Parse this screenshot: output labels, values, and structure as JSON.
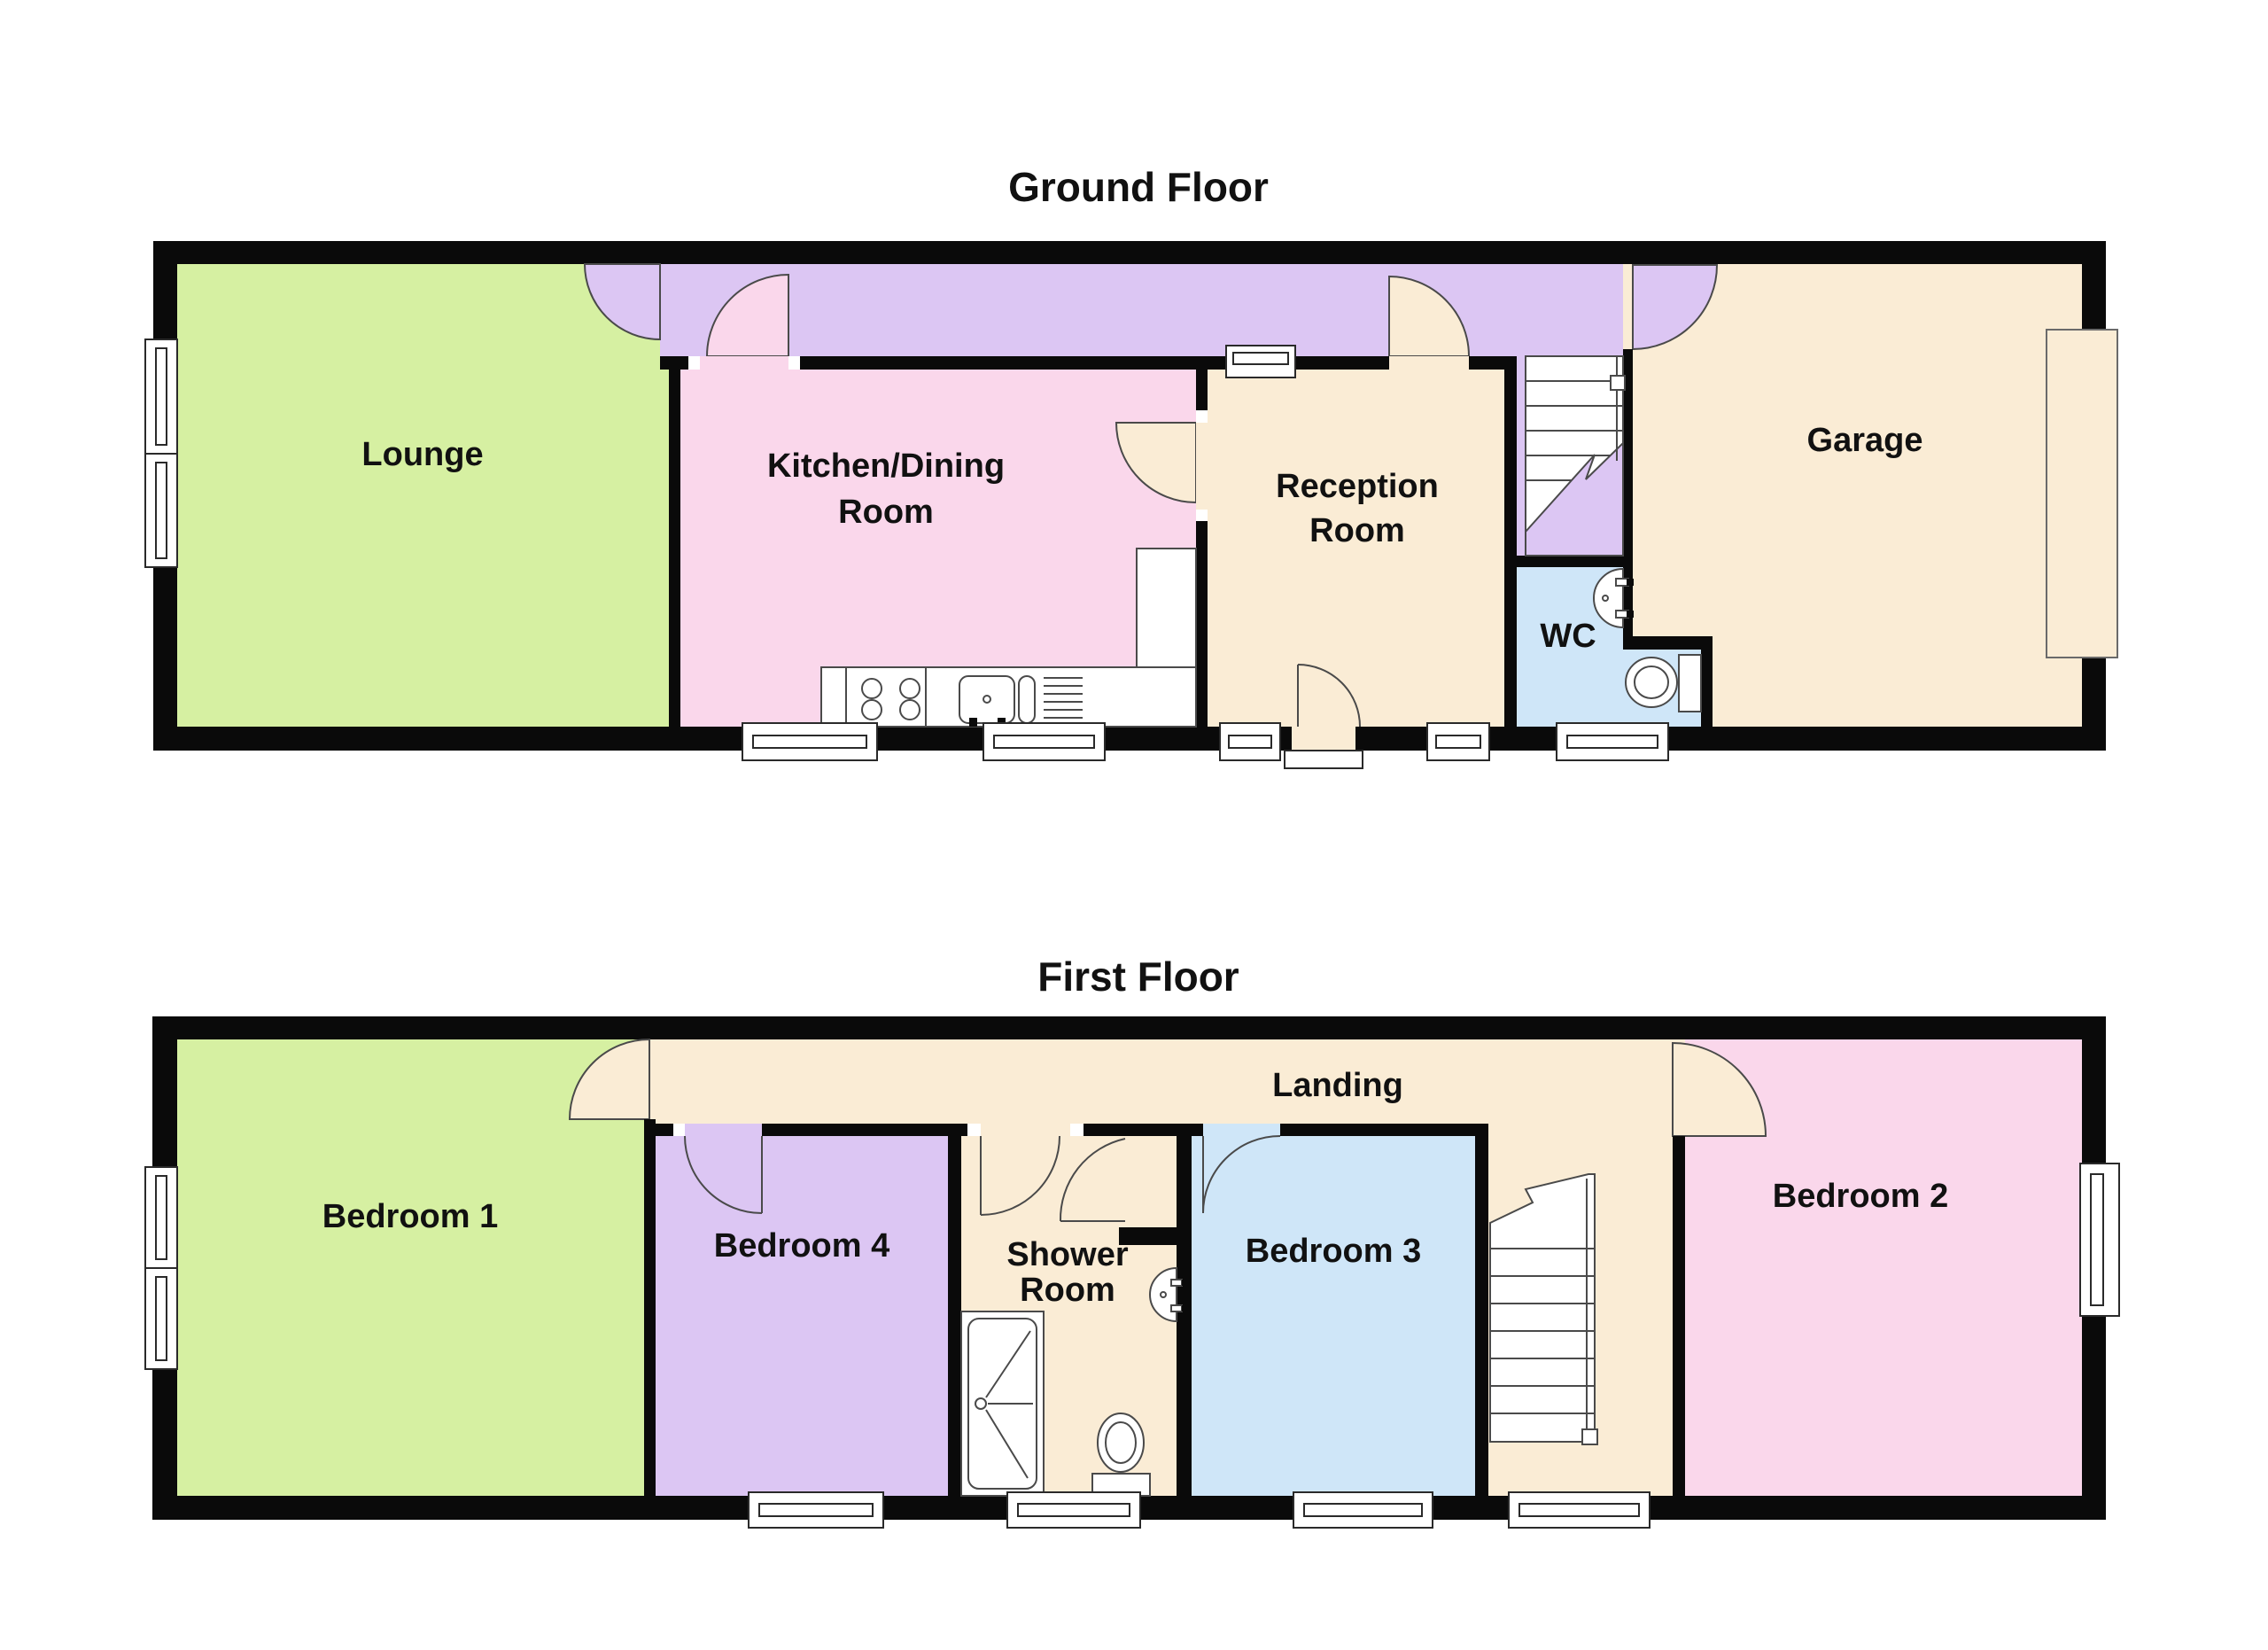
{
  "document_type": "floorplan",
  "colors": {
    "wall": "#0a0a0a",
    "lounge": "#d6f0a2",
    "kitchen": "#fad7eb",
    "hallway": "#dcc6f3",
    "reception": "#faecd5",
    "wc": "#cfe6f8",
    "garage": "#faecd5",
    "landing": "#faecd5",
    "bedroom1": "#d6f0a2",
    "bedroom2": "#fad7eb",
    "bedroom3": "#cfe6f8",
    "bedroom4": "#dcc6f3",
    "shower_room": "#faecd5",
    "window": "#ffffff"
  },
  "ground_floor": {
    "title": "Ground Floor",
    "rooms": [
      {
        "name": "lounge",
        "label": "Lounge"
      },
      {
        "name": "kitchen-dining-room",
        "label": "Kitchen/Dining Room",
        "label_lines": [
          "Kitchen/Dining",
          "Room"
        ]
      },
      {
        "name": "reception-room",
        "label": "Reception Room",
        "label_lines": [
          "Reception",
          "Room"
        ]
      },
      {
        "name": "wc",
        "label": "WC"
      },
      {
        "name": "garage",
        "label": "Garage"
      }
    ],
    "fixtures": [
      "staircase",
      "under-stairs",
      "kitchen-hob",
      "kitchen-sink",
      "kitchen-counter",
      "wc-basin",
      "wc-toilet",
      "garage-door",
      "front-door-step"
    ],
    "window_count": 8,
    "door_count": 6
  },
  "first_floor": {
    "title": "First Floor",
    "rooms": [
      {
        "name": "bedroom-1",
        "label": "Bedroom 1"
      },
      {
        "name": "bedroom-4",
        "label": "Bedroom 4"
      },
      {
        "name": "shower-room",
        "label": "Shower Room",
        "label_lines": [
          "Shower",
          "Room"
        ]
      },
      {
        "name": "bedroom-3",
        "label": "Bedroom 3"
      },
      {
        "name": "bedroom-2",
        "label": "Bedroom 2"
      },
      {
        "name": "landing",
        "label": "Landing"
      }
    ],
    "fixtures": [
      "staircase",
      "shower-cubicle",
      "wash-basin",
      "toilet"
    ],
    "window_count": 6,
    "door_count": 5
  }
}
